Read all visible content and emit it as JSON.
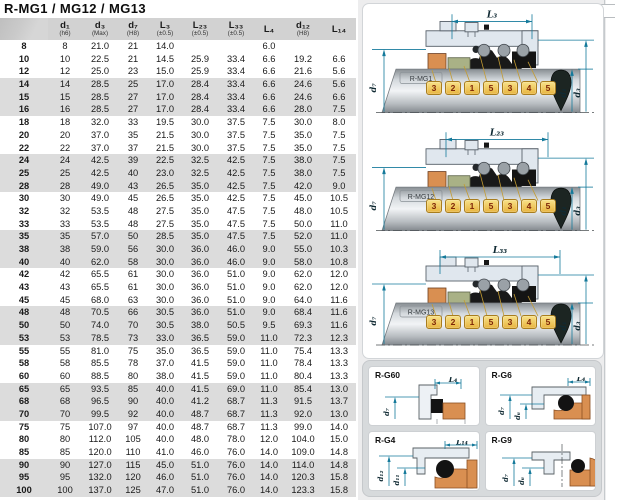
{
  "title": "R-MG1 / MG12 / MG13",
  "table": {
    "headers": [
      {
        "main": "d₁",
        "note": "(h6)"
      },
      {
        "main": "d₃",
        "note": "(Max)"
      },
      {
        "main": "d₇",
        "note": "(H8)"
      },
      {
        "main": "L₃",
        "note": "(±0.5)"
      },
      {
        "main": "L₂₃",
        "note": "(±0.5)"
      },
      {
        "main": "L₃₃",
        "note": "(±0.5)"
      },
      {
        "main": "L₄",
        "note": ""
      },
      {
        "main": "d₁₂",
        "note": "(H8)"
      },
      {
        "main": "L₁₄",
        "note": ""
      }
    ],
    "rows": [
      [
        "8",
        "8",
        "21.0",
        "21",
        "14.0",
        "",
        "",
        "6.0",
        "",
        ""
      ],
      [
        "10",
        "10",
        "22.5",
        "21",
        "14.5",
        "25.9",
        "33.4",
        "6.6",
        "19.2",
        "6.6"
      ],
      [
        "12",
        "12",
        "25.0",
        "23",
        "15.0",
        "25.9",
        "33.4",
        "6.6",
        "21.6",
        "5.6"
      ],
      [
        "14",
        "14",
        "28.5",
        "25",
        "17.0",
        "28.4",
        "33.4",
        "6.6",
        "24.6",
        "5.6"
      ],
      [
        "15",
        "15",
        "28.5",
        "27",
        "17.0",
        "28.4",
        "33.4",
        "6.6",
        "24.6",
        "6.6"
      ],
      [
        "16",
        "16",
        "28.5",
        "27",
        "17.0",
        "28.4",
        "33.4",
        "6.6",
        "28.0",
        "7.5"
      ],
      [
        "18",
        "18",
        "32.0",
        "33",
        "19.5",
        "30.0",
        "37.5",
        "7.5",
        "30.0",
        "8.0"
      ],
      [
        "20",
        "20",
        "37.0",
        "35",
        "21.5",
        "30.0",
        "37.5",
        "7.5",
        "35.0",
        "7.5"
      ],
      [
        "22",
        "22",
        "37.0",
        "37",
        "21.5",
        "30.0",
        "37.5",
        "7.5",
        "35.0",
        "7.5"
      ],
      [
        "24",
        "24",
        "42.5",
        "39",
        "22.5",
        "32.5",
        "42.5",
        "7.5",
        "38.0",
        "7.5"
      ],
      [
        "25",
        "25",
        "42.5",
        "40",
        "23.0",
        "32.5",
        "42.5",
        "7.5",
        "38.0",
        "7.5"
      ],
      [
        "28",
        "28",
        "49.0",
        "43",
        "26.5",
        "35.0",
        "42.5",
        "7.5",
        "42.0",
        "9.0"
      ],
      [
        "30",
        "30",
        "49.0",
        "45",
        "26.5",
        "35.0",
        "42.5",
        "7.5",
        "45.0",
        "10.5"
      ],
      [
        "32",
        "32",
        "53.5",
        "48",
        "27.5",
        "35.0",
        "47.5",
        "7.5",
        "48.0",
        "10.5"
      ],
      [
        "33",
        "33",
        "53.5",
        "48",
        "27.5",
        "35.0",
        "47.5",
        "7.5",
        "50.0",
        "11.0"
      ],
      [
        "35",
        "35",
        "57.0",
        "50",
        "28.5",
        "35.0",
        "47.5",
        "7.5",
        "52.0",
        "11.0"
      ],
      [
        "38",
        "38",
        "59.0",
        "56",
        "30.0",
        "36.0",
        "46.0",
        "9.0",
        "55.0",
        "10.3"
      ],
      [
        "40",
        "40",
        "62.0",
        "58",
        "30.0",
        "36.0",
        "46.0",
        "9.0",
        "58.0",
        "10.8"
      ],
      [
        "42",
        "42",
        "65.5",
        "61",
        "30.0",
        "36.0",
        "51.0",
        "9.0",
        "62.0",
        "12.0"
      ],
      [
        "43",
        "43",
        "65.5",
        "61",
        "30.0",
        "36.0",
        "51.0",
        "9.0",
        "62.0",
        "12.0"
      ],
      [
        "45",
        "45",
        "68.0",
        "63",
        "30.0",
        "36.0",
        "51.0",
        "9.0",
        "64.0",
        "11.6"
      ],
      [
        "48",
        "48",
        "70.5",
        "66",
        "30.5",
        "36.0",
        "51.0",
        "9.0",
        "68.4",
        "11.6"
      ],
      [
        "50",
        "50",
        "74.0",
        "70",
        "30.5",
        "38.0",
        "50.5",
        "9.5",
        "69.3",
        "11.6"
      ],
      [
        "53",
        "53",
        "78.5",
        "73",
        "33.0",
        "36.5",
        "59.0",
        "11.0",
        "72.3",
        "12.3"
      ],
      [
        "55",
        "55",
        "81.0",
        "75",
        "35.0",
        "36.5",
        "59.0",
        "11.0",
        "75.4",
        "13.3"
      ],
      [
        "58",
        "58",
        "85.5",
        "78",
        "37.0",
        "41.5",
        "59.0",
        "11.0",
        "78.4",
        "13.3"
      ],
      [
        "60",
        "60",
        "88.5",
        "80",
        "38.0",
        "41.5",
        "59.0",
        "11.0",
        "80.4",
        "13.3"
      ],
      [
        "65",
        "65",
        "93.5",
        "85",
        "40.0",
        "41.5",
        "69.0",
        "11.0",
        "85.4",
        "13.0"
      ],
      [
        "68",
        "68",
        "96.5",
        "90",
        "40.0",
        "41.2",
        "68.7",
        "11.3",
        "91.5",
        "13.7"
      ],
      [
        "70",
        "70",
        "99.5",
        "92",
        "40.0",
        "48.7",
        "68.7",
        "11.3",
        "92.0",
        "13.0"
      ],
      [
        "75",
        "75",
        "107.0",
        "97",
        "40.0",
        "48.7",
        "68.7",
        "11.3",
        "99.0",
        "14.0"
      ],
      [
        "80",
        "80",
        "112.0",
        "105",
        "40.0",
        "48.0",
        "78.0",
        "12.0",
        "104.0",
        "15.0"
      ],
      [
        "85",
        "85",
        "120.0",
        "110",
        "41.0",
        "46.0",
        "76.0",
        "14.0",
        "109.0",
        "14.8"
      ],
      [
        "90",
        "90",
        "127.0",
        "115",
        "45.0",
        "51.0",
        "76.0",
        "14.0",
        "114.0",
        "14.8"
      ],
      [
        "95",
        "95",
        "132.0",
        "120",
        "46.0",
        "51.0",
        "76.0",
        "14.0",
        "120.3",
        "15.8"
      ],
      [
        "100",
        "100",
        "137.0",
        "125",
        "47.0",
        "51.0",
        "76.0",
        "14.0",
        "123.3",
        "15.8"
      ]
    ]
  },
  "diagrams": [
    {
      "model": "R-MG1",
      "dim_label": "L₃",
      "d_left": "d₇",
      "d_right_inner": "d₁",
      "d_right_outer": "d₃",
      "part_tags": [
        "3",
        "2",
        "1",
        "5",
        "3",
        "4",
        "5"
      ]
    },
    {
      "model": "R-MG12",
      "dim_label": "L₂₃",
      "d_left": "d₇",
      "d_right_inner": "d₁",
      "d_right_outer": "d₃",
      "part_tags": [
        "3",
        "2",
        "1",
        "5",
        "3",
        "4",
        "5"
      ]
    },
    {
      "model": "R-MG13",
      "dim_label": "L₃₃",
      "d_left": "d₇",
      "d_right_inner": "d₁",
      "d_right_outer": "d₃",
      "part_tags": [
        "3",
        "2",
        "1",
        "5",
        "3",
        "4",
        "5"
      ]
    }
  ],
  "detail_panels": [
    {
      "label": "R-G60",
      "top_dim": "L₄",
      "dim_a": "d₇",
      "dim_b": ""
    },
    {
      "label": "R-G6",
      "top_dim": "L₄",
      "dim_a": "d₇",
      "dim_b": "d₆"
    },
    {
      "label": "R-G4",
      "top_dim": "L₁₄",
      "dim_a": "d₁₂",
      "dim_b": "d₁₁"
    },
    {
      "label": "R-G9",
      "top_dim": "",
      "dim_a": "d₇",
      "dim_b": "d₆"
    }
  ],
  "colors": {
    "dimension_accent": "#157a9b",
    "tag_fill": "#f0c95c",
    "tag_text": "#7e2507",
    "part_orange": "#d98f51",
    "part_green": "#a9b186",
    "table_band": "#dcdcdc",
    "header_bg": "#d2d2d2"
  }
}
